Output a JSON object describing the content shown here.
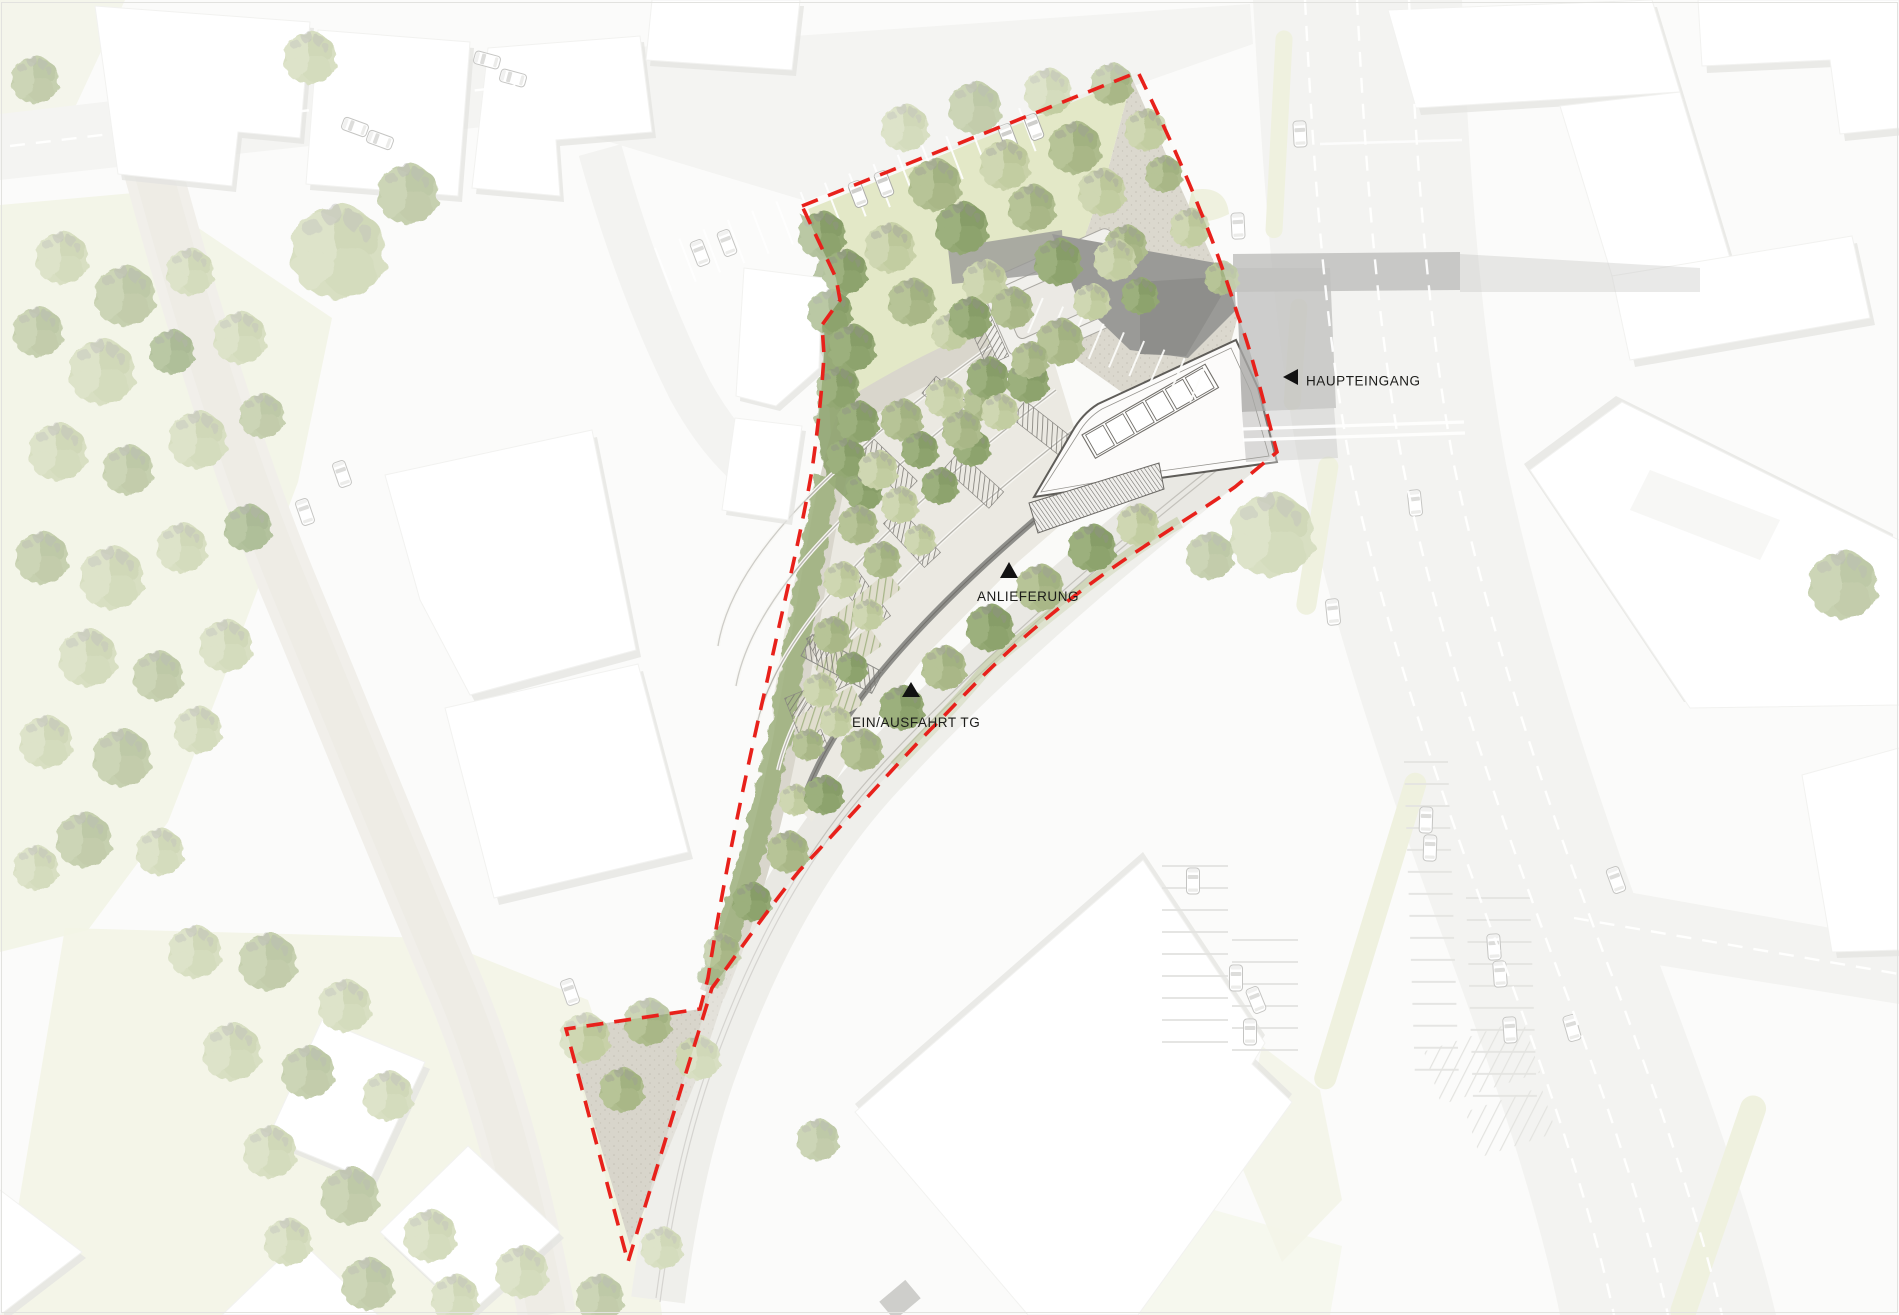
{
  "plan": {
    "kind": "architectural-site-plan",
    "annotations": [
      {
        "id": "haupteingang",
        "text": "HAUPTEINGANG",
        "marker_icon": "left-triangle-icon"
      },
      {
        "id": "anlieferung",
        "text": "ANLIEFERUNG",
        "marker_icon": "up-triangle-icon"
      },
      {
        "id": "ein-ausfahrt-tg",
        "text": "EIN/AUSFAHRT TG",
        "marker_icon": "up-triangle-icon"
      }
    ],
    "colors": {
      "site_boundary": "#e8211b",
      "annotation_text": "#1c1c1a",
      "annotation_marker": "#121212",
      "canopy": "#9a9a97",
      "lawn": "#e3e8c7",
      "gravel": "#dbd8ce",
      "road": "#f0f0ed",
      "median": "#e8ebd1",
      "tree_light": "#c8d1a8",
      "tree_mid": "#aebc8d",
      "tree_dark": "#93a873",
      "building": "#ffffff",
      "building_shadow": "#d8d8d4",
      "roof_outline": "#5f5d59"
    }
  }
}
